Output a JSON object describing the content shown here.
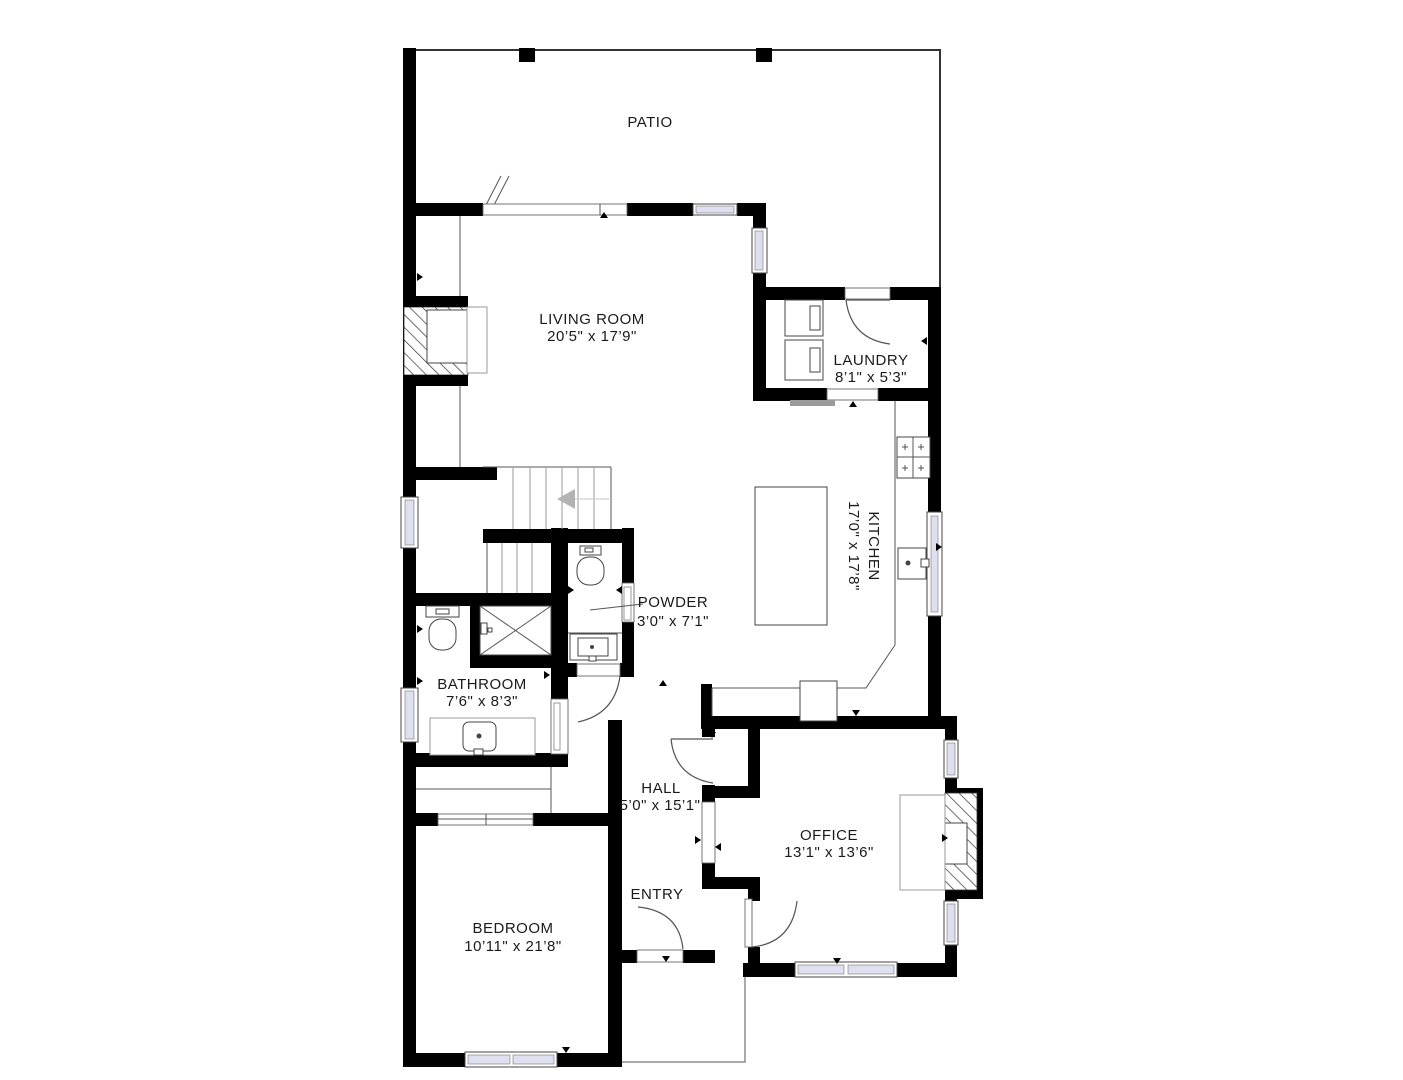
{
  "floorplan": {
    "rooms": {
      "patio": {
        "name": "PATIO"
      },
      "living_room": {
        "name": "LIVING ROOM",
        "dims": "20’5\" x 17’9\""
      },
      "laundry": {
        "name": "LAUNDRY",
        "dims": "8’1\" x 5’3\""
      },
      "kitchen": {
        "name": "KITCHEN",
        "dims": "17’0\" x 17’8\""
      },
      "powder": {
        "name": "POWDER",
        "dims": "3’0\" x 7’1\""
      },
      "bathroom": {
        "name": "BATHROOM",
        "dims": "7’6\" x 8’3\""
      },
      "hall": {
        "name": "HALL",
        "dims": "5’0\" x 15’1\""
      },
      "entry": {
        "name": "ENTRY"
      },
      "office": {
        "name": "OFFICE",
        "dims": "13’1\" x 13’6\""
      },
      "bedroom": {
        "name": "BEDROOM",
        "dims": "10’11\" x 21’8\""
      }
    },
    "colors": {
      "wall": "#000000",
      "line": "#555555",
      "window_glass": "#dfe0ef",
      "stair_arrow": "#b3b3b3",
      "text": "#1a1a1a",
      "background": "#ffffff"
    }
  }
}
